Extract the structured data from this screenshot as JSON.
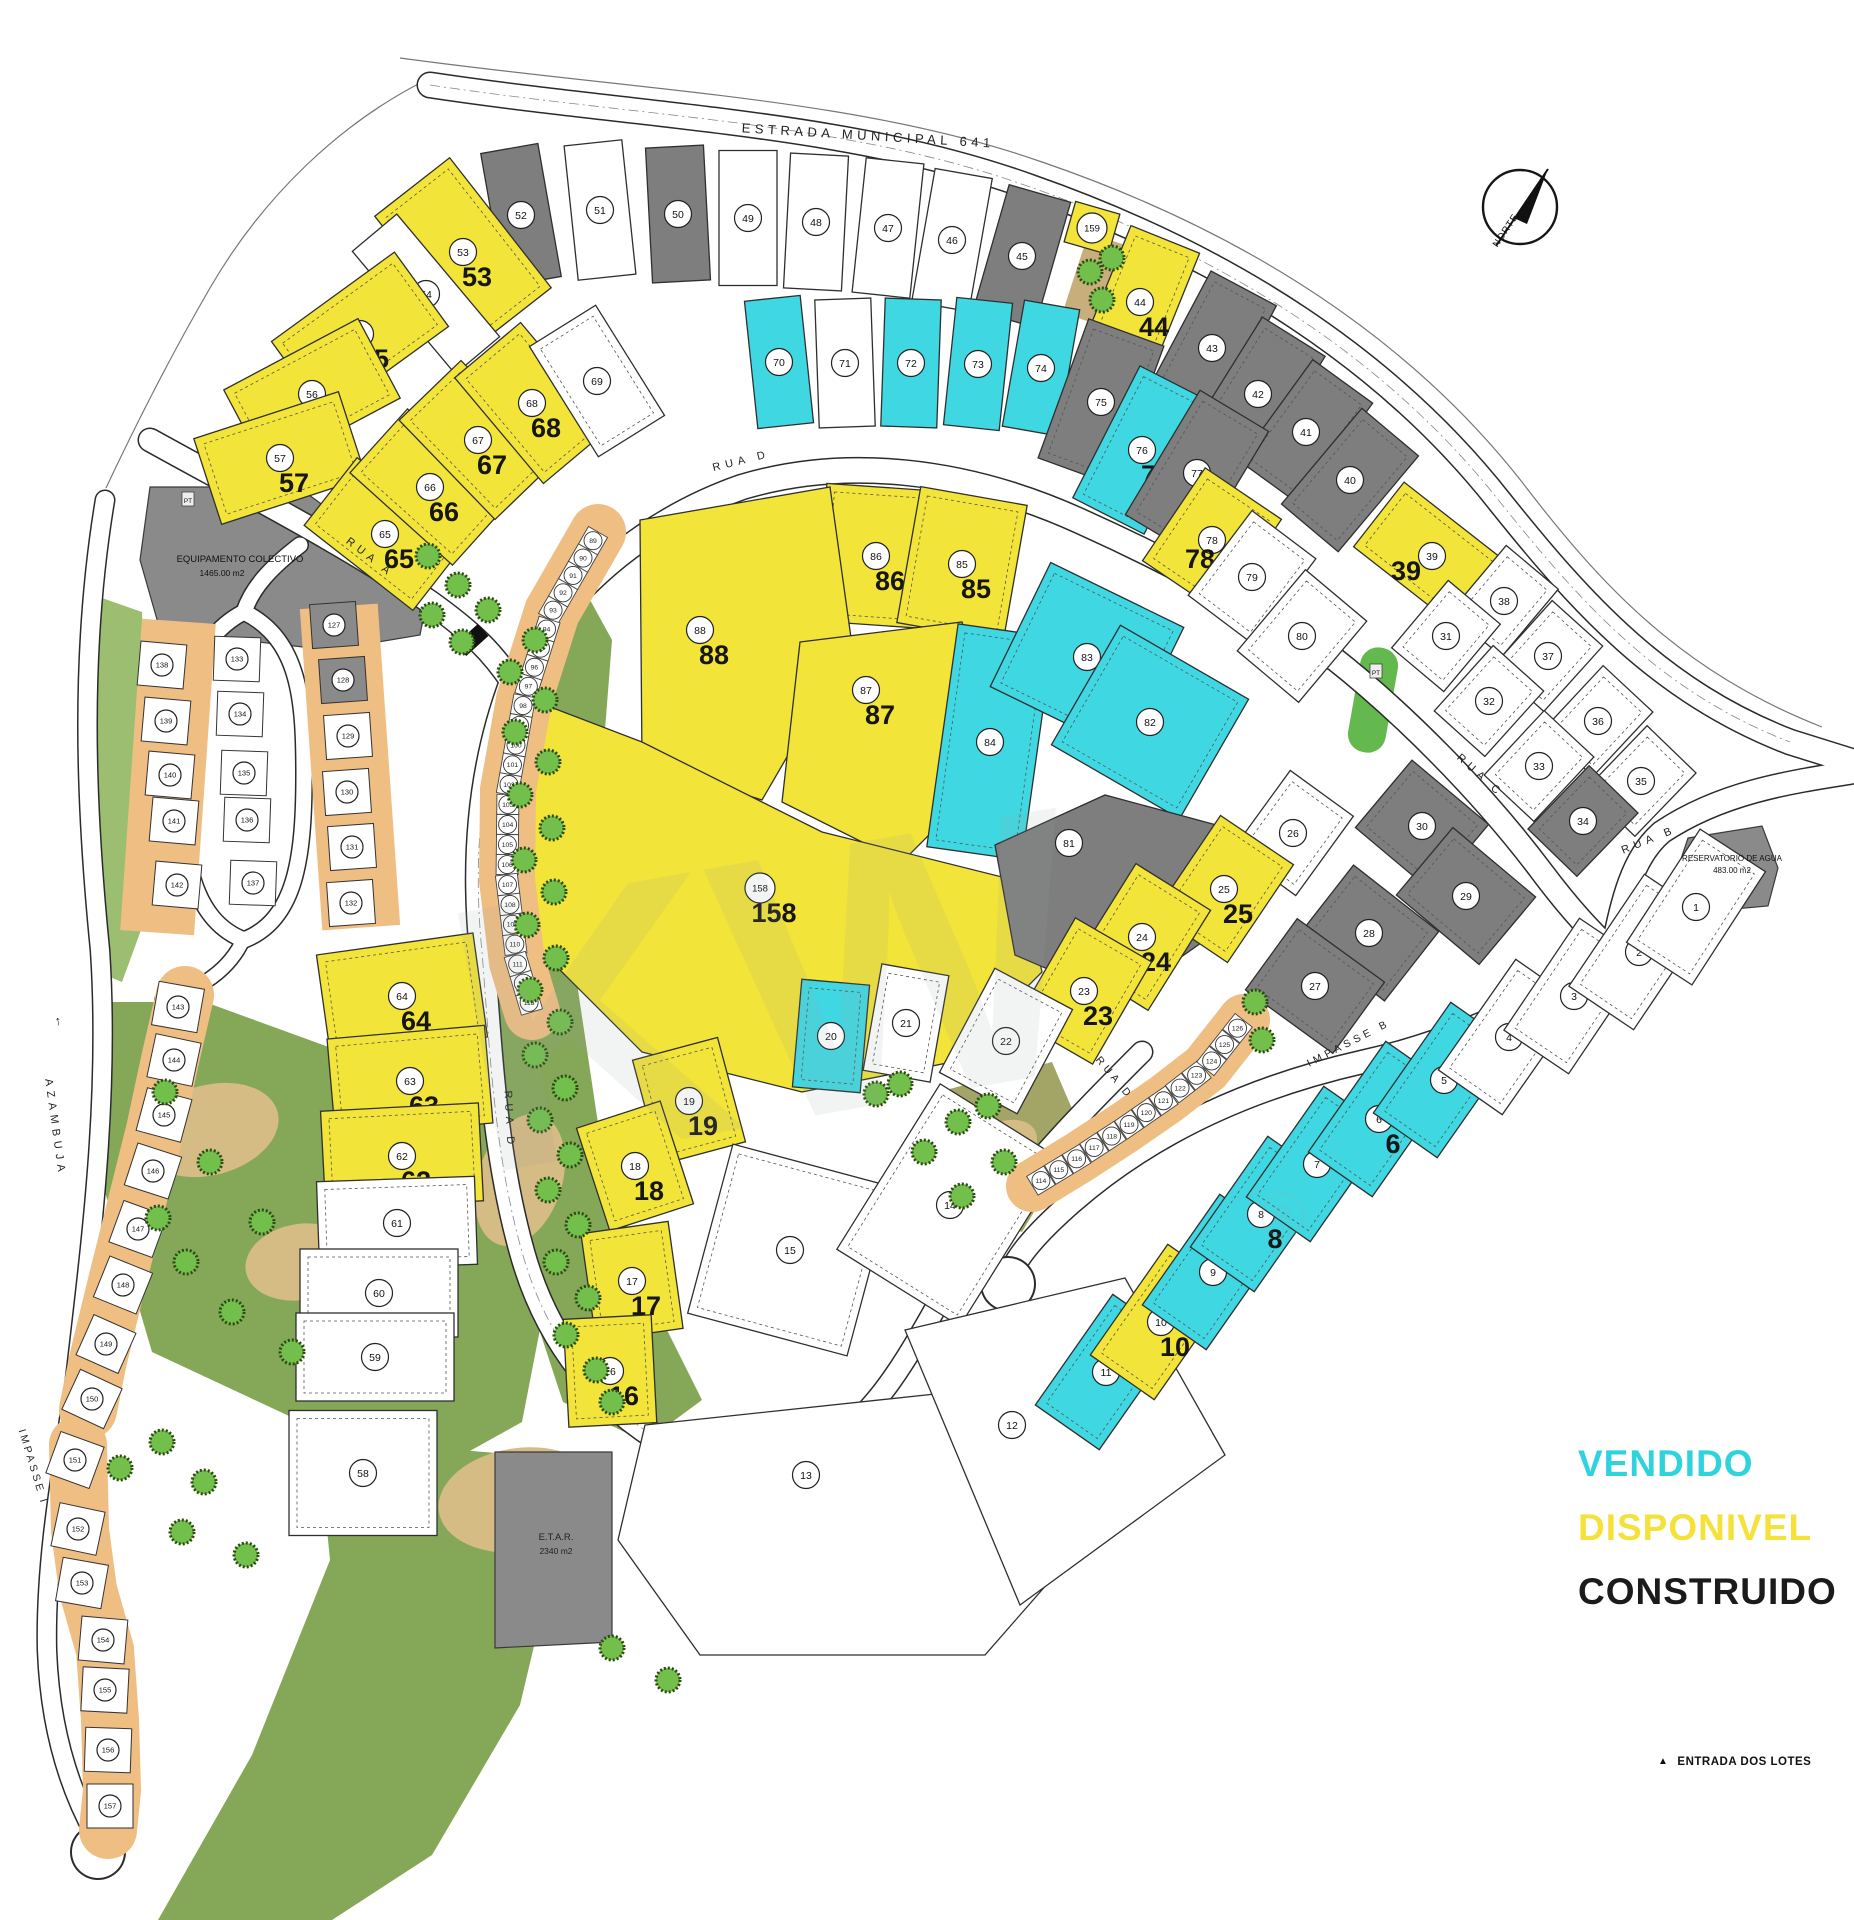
{
  "legend": {
    "items": [
      {
        "id": "vendido",
        "label": "VENDIDO",
        "color": "#2FD3DE"
      },
      {
        "id": "disponivel",
        "label": "DISPONIVEL",
        "color": "#F4E23B"
      },
      {
        "id": "construido",
        "label": "CONSTRUIDO",
        "color": "#1B1B1B"
      }
    ]
  },
  "notes": {
    "entrance": "ENTRADA DOS LOTES"
  },
  "north_label": "NORTE",
  "roads": {
    "estrada": "ESTRADA MUNICIPAL 641",
    "rua_a": "RUA A",
    "rua_b": "RUA B",
    "rua_c": "RUA C",
    "rua_d": "RUA D",
    "impasse_b": "IMPASSE B",
    "impasse_i": "IMPASSE I",
    "azambuja": "AZAMBUJA"
  },
  "areas": {
    "equipamento": {
      "name": "EQUIPAMENTO COLECTIVO",
      "area": "1465.00 m2"
    },
    "reservatorio": {
      "name": "RESERVATORIO DE AGUA",
      "area": "483.00 m2"
    },
    "etar": {
      "name": "E.T.A.R.",
      "area": "2340 m2"
    },
    "pt_marker": "PT"
  },
  "status_colors": {
    "v": "#3FD8E2",
    "d": "#F2E438",
    "c": "#7E7E7E",
    "w": "#FFFFFF"
  },
  "status_names": {
    "v": "vendido",
    "d": "disponivel",
    "c": "construido",
    "w": "livre"
  },
  "arcs": {
    "west_townhouses": {
      "start": 89,
      "end": 113
    },
    "south_townhouses": {
      "start": 114,
      "end": 126
    }
  },
  "plots": [
    {
      "n": 52,
      "s": "c",
      "x": 521,
      "y": 215,
      "w": 58,
      "h": 135,
      "a": -10
    },
    {
      "n": 51,
      "s": "w",
      "x": 600,
      "y": 210,
      "w": 58,
      "h": 135,
      "a": -6
    },
    {
      "n": 50,
      "s": "c",
      "x": 678,
      "y": 214,
      "w": 58,
      "h": 135,
      "a": -3
    },
    {
      "n": 49,
      "s": "w",
      "x": 748,
      "y": 218,
      "w": 58,
      "h": 135,
      "a": 0
    },
    {
      "n": 48,
      "s": "w",
      "x": 816,
      "y": 222,
      "w": 58,
      "h": 135,
      "a": 3
    },
    {
      "n": 47,
      "s": "w",
      "x": 888,
      "y": 228,
      "w": 58,
      "h": 135,
      "a": 6
    },
    {
      "n": 46,
      "s": "w",
      "x": 952,
      "y": 240,
      "w": 58,
      "h": 135,
      "a": 10
    },
    {
      "n": 45,
      "s": "c",
      "x": 1022,
      "y": 256,
      "w": 64,
      "h": 130,
      "a": 16
    },
    {
      "n": 159,
      "s": "d",
      "x": 1092,
      "y": 228,
      "w": 46,
      "h": 42,
      "a": 16
    },
    {
      "n": 44,
      "s": "d",
      "x": 1140,
      "y": 302,
      "w": 74,
      "h": 135,
      "a": 22,
      "b": 1
    },
    {
      "n": 43,
      "s": "c",
      "x": 1212,
      "y": 348,
      "w": 74,
      "h": 135,
      "a": 28
    },
    {
      "n": 42,
      "s": "c",
      "x": 1258,
      "y": 394,
      "w": 74,
      "h": 135,
      "a": 32
    },
    {
      "n": 41,
      "s": "c",
      "x": 1306,
      "y": 432,
      "w": 74,
      "h": 125,
      "a": 36
    },
    {
      "n": 40,
      "s": "c",
      "x": 1350,
      "y": 480,
      "w": 74,
      "h": 125,
      "a": 40
    },
    {
      "n": 53,
      "s": "d",
      "x": 463,
      "y": 252,
      "w": 95,
      "h": 165,
      "a": -38,
      "b": 1
    },
    {
      "n": 54,
      "s": "w",
      "x": 426,
      "y": 294,
      "w": 58,
      "h": 160,
      "a": -40
    },
    {
      "n": 55,
      "s": "d",
      "x": 360,
      "y": 334,
      "w": 152,
      "h": 92,
      "a": -36,
      "b": 1
    },
    {
      "n": 56,
      "s": "d",
      "x": 312,
      "y": 394,
      "w": 152,
      "h": 90,
      "a": -28,
      "b": 1
    },
    {
      "n": 57,
      "s": "d",
      "x": 280,
      "y": 458,
      "w": 152,
      "h": 90,
      "a": -18,
      "b": 1
    },
    {
      "n": 65,
      "s": "d",
      "x": 385,
      "y": 534,
      "w": 86,
      "h": 138,
      "a": -52,
      "b": 1
    },
    {
      "n": 66,
      "s": "d",
      "x": 430,
      "y": 487,
      "w": 86,
      "h": 138,
      "a": -48,
      "b": 1
    },
    {
      "n": 67,
      "s": "d",
      "x": 478,
      "y": 440,
      "w": 86,
      "h": 138,
      "a": -44,
      "b": 1
    },
    {
      "n": 68,
      "s": "d",
      "x": 532,
      "y": 403,
      "w": 86,
      "h": 138,
      "a": -40,
      "b": 1
    },
    {
      "n": 69,
      "s": "w",
      "x": 597,
      "y": 381,
      "w": 78,
      "h": 130,
      "a": -32
    },
    {
      "n": 70,
      "s": "v",
      "x": 779,
      "y": 362,
      "w": 56,
      "h": 128,
      "a": -6
    },
    {
      "n": 71,
      "s": "w",
      "x": 845,
      "y": 363,
      "w": 56,
      "h": 128,
      "a": -2
    },
    {
      "n": 72,
      "s": "v",
      "x": 911,
      "y": 363,
      "w": 56,
      "h": 128,
      "a": 2
    },
    {
      "n": 73,
      "s": "v",
      "x": 978,
      "y": 364,
      "w": 56,
      "h": 128,
      "a": 6
    },
    {
      "n": 74,
      "s": "v",
      "x": 1041,
      "y": 368,
      "w": 56,
      "h": 128,
      "a": 10
    },
    {
      "n": 75,
      "s": "c",
      "x": 1101,
      "y": 402,
      "w": 80,
      "h": 148,
      "a": 20
    },
    {
      "n": 76,
      "s": "v",
      "x": 1142,
      "y": 450,
      "w": 80,
      "h": 148,
      "a": 27,
      "b": 1
    },
    {
      "n": 77,
      "s": "c",
      "x": 1197,
      "y": 473,
      "w": 80,
      "h": 145,
      "a": 31
    },
    {
      "n": 78,
      "s": "d",
      "x": 1212,
      "y": 540,
      "w": 92,
      "h": 112,
      "a": 34,
      "b": 1,
      "dx": -12,
      "dy": 28
    },
    {
      "n": 79,
      "s": "w",
      "x": 1252,
      "y": 577,
      "w": 80,
      "h": 106,
      "a": 37
    },
    {
      "n": 80,
      "s": "w",
      "x": 1302,
      "y": 636,
      "w": 80,
      "h": 106,
      "a": 40
    },
    {
      "n": 39,
      "s": "d",
      "x": 1432,
      "y": 556,
      "w": 135,
      "h": 82,
      "a": 38,
      "b": 1,
      "dx": -26,
      "dy": 24
    },
    {
      "n": 38,
      "s": "w",
      "x": 1504,
      "y": 601,
      "w": 68,
      "h": 88,
      "a": 40
    },
    {
      "n": 31,
      "s": "w",
      "x": 1446,
      "y": 636,
      "w": 68,
      "h": 88,
      "a": 40
    },
    {
      "n": 37,
      "s": "w",
      "x": 1548,
      "y": 656,
      "w": 68,
      "h": 88,
      "a": 42
    },
    {
      "n": 32,
      "s": "w",
      "x": 1489,
      "y": 701,
      "w": 68,
      "h": 88,
      "a": 42
    },
    {
      "n": 36,
      "s": "w",
      "x": 1598,
      "y": 721,
      "w": 68,
      "h": 88,
      "a": 43
    },
    {
      "n": 33,
      "s": "w",
      "x": 1539,
      "y": 766,
      "w": 68,
      "h": 88,
      "a": 43
    },
    {
      "n": 35,
      "s": "w",
      "x": 1641,
      "y": 781,
      "w": 68,
      "h": 88,
      "a": 44
    },
    {
      "n": 34,
      "s": "c",
      "x": 1583,
      "y": 821,
      "w": 68,
      "h": 88,
      "a": 44
    },
    {
      "n": 86,
      "s": "d",
      "x": 876,
      "y": 556,
      "w": 108,
      "h": 138,
      "a": 4,
      "b": 1
    },
    {
      "n": 85,
      "s": "d",
      "x": 962,
      "y": 564,
      "w": 108,
      "h": 138,
      "a": 10,
      "b": 1
    },
    {
      "n": 88,
      "s": "d",
      "p": "640,520 830,487 852,645 762,800 642,762",
      "x": 700,
      "y": 630,
      "b": 1
    },
    {
      "n": 87,
      "s": "d",
      "p": "800,642 962,622 1002,762 902,862 782,802",
      "x": 866,
      "y": 690,
      "b": 1
    },
    {
      "n": 158,
      "s": "d",
      "p": "532,700 642,742 822,832 1022,882 1042,972 952,1062 802,1092 642,1052 542,952 512,802",
      "x": 760,
      "y": 888,
      "b": 1
    },
    {
      "n": 84,
      "s": "v",
      "x": 990,
      "y": 742,
      "w": 96,
      "h": 225,
      "a": 8
    },
    {
      "n": 83,
      "s": "v",
      "x": 1087,
      "y": 657,
      "w": 148,
      "h": 138,
      "a": 26
    },
    {
      "n": 82,
      "s": "v",
      "x": 1150,
      "y": 722,
      "w": 148,
      "h": 138,
      "a": 30
    },
    {
      "n": 81,
      "s": "c",
      "p": "995,845 1105,795 1235,830 1255,905 1120,1000 1015,955",
      "x": 1069,
      "y": 843
    },
    {
      "n": 30,
      "s": "c",
      "x": 1422,
      "y": 826,
      "w": 100,
      "h": 88,
      "a": 40
    },
    {
      "n": 29,
      "s": "c",
      "x": 1466,
      "y": 896,
      "w": 108,
      "h": 88,
      "a": 40
    },
    {
      "n": 28,
      "s": "c",
      "x": 1369,
      "y": 933,
      "w": 108,
      "h": 88,
      "a": 38
    },
    {
      "n": 27,
      "s": "c",
      "x": 1315,
      "y": 986,
      "w": 108,
      "h": 88,
      "a": 36
    },
    {
      "n": 26,
      "s": "w",
      "x": 1293,
      "y": 833,
      "w": 78,
      "h": 98,
      "a": 36
    },
    {
      "n": 25,
      "s": "d",
      "x": 1224,
      "y": 889,
      "w": 88,
      "h": 118,
      "a": 34,
      "b": 1
    },
    {
      "n": 24,
      "s": "d",
      "x": 1142,
      "y": 937,
      "w": 88,
      "h": 118,
      "a": 32,
      "b": 1
    },
    {
      "n": 23,
      "s": "d",
      "x": 1084,
      "y": 991,
      "w": 88,
      "h": 118,
      "a": 30,
      "b": 1
    },
    {
      "n": 22,
      "s": "w",
      "x": 1006,
      "y": 1041,
      "w": 88,
      "h": 118,
      "a": 28
    },
    {
      "n": 21,
      "s": "w",
      "x": 906,
      "y": 1023,
      "w": 68,
      "h": 108,
      "a": 10
    },
    {
      "n": 20,
      "s": "v",
      "x": 831,
      "y": 1036,
      "w": 68,
      "h": 108,
      "a": 5
    },
    {
      "n": 19,
      "s": "d",
      "x": 689,
      "y": 1101,
      "w": 88,
      "h": 108,
      "a": -15,
      "b": 1
    },
    {
      "n": 18,
      "s": "d",
      "x": 635,
      "y": 1166,
      "w": 88,
      "h": 108,
      "a": -18,
      "b": 1
    },
    {
      "n": 17,
      "s": "d",
      "x": 632,
      "y": 1281,
      "w": 88,
      "h": 108,
      "a": -8,
      "b": 1
    },
    {
      "n": 16,
      "s": "d",
      "x": 610,
      "y": 1371,
      "w": 88,
      "h": 108,
      "a": -3,
      "b": 1
    },
    {
      "n": 15,
      "s": "w",
      "x": 790,
      "y": 1250,
      "w": 165,
      "h": 175,
      "a": 15
    },
    {
      "n": 14,
      "s": "w",
      "x": 950,
      "y": 1205,
      "w": 145,
      "h": 195,
      "a": 32
    },
    {
      "n": 13,
      "s": "w",
      "p": "645,1425 1085,1378 1125,1495 985,1655 700,1655 618,1540",
      "x": 806,
      "y": 1475
    },
    {
      "n": 12,
      "s": "w",
      "p": "905,1330 1125,1278 1225,1455 1020,1605",
      "x": 1012,
      "y": 1425
    },
    {
      "n": 11,
      "s": "v",
      "x": 1106,
      "y": 1372,
      "w": 78,
      "h": 135,
      "a": 35
    },
    {
      "n": 10,
      "s": "d",
      "x": 1161,
      "y": 1322,
      "w": 78,
      "h": 135,
      "a": 35,
      "b": 1
    },
    {
      "n": 9,
      "s": "v",
      "x": 1213,
      "y": 1272,
      "w": 78,
      "h": 135,
      "a": 35
    },
    {
      "n": 8,
      "s": "v",
      "x": 1261,
      "y": 1214,
      "w": 78,
      "h": 135,
      "a": 35,
      "b": 1
    },
    {
      "n": 7,
      "s": "v",
      "x": 1317,
      "y": 1164,
      "w": 78,
      "h": 135,
      "a": 35
    },
    {
      "n": 6,
      "s": "v",
      "x": 1379,
      "y": 1119,
      "w": 78,
      "h": 135,
      "a": 35,
      "b": 1
    },
    {
      "n": 5,
      "s": "v",
      "x": 1444,
      "y": 1080,
      "w": 78,
      "h": 135,
      "a": 35
    },
    {
      "n": 4,
      "s": "w",
      "x": 1509,
      "y": 1037,
      "w": 78,
      "h": 135,
      "a": 35
    },
    {
      "n": 3,
      "s": "w",
      "x": 1574,
      "y": 996,
      "w": 78,
      "h": 135,
      "a": 34
    },
    {
      "n": 2,
      "s": "w",
      "x": 1639,
      "y": 952,
      "w": 78,
      "h": 135,
      "a": 34
    },
    {
      "n": 1,
      "s": "w",
      "x": 1696,
      "y": 907,
      "w": 78,
      "h": 135,
      "a": 33
    },
    {
      "n": 64,
      "s": "d",
      "x": 402,
      "y": 996,
      "w": 158,
      "h": 105,
      "a": -8,
      "b": 1
    },
    {
      "n": 63,
      "s": "d",
      "x": 410,
      "y": 1081,
      "w": 158,
      "h": 98,
      "a": -5,
      "b": 1
    },
    {
      "n": 62,
      "s": "d",
      "x": 402,
      "y": 1156,
      "w": 158,
      "h": 98,
      "a": -3,
      "b": 1
    },
    {
      "n": 61,
      "s": "w",
      "x": 397,
      "y": 1223,
      "w": 158,
      "h": 88,
      "a": -2
    },
    {
      "n": 60,
      "s": "w",
      "x": 379,
      "y": 1293,
      "w": 158,
      "h": 88,
      "a": 0
    },
    {
      "n": 59,
      "s": "w",
      "x": 375,
      "y": 1357,
      "w": 158,
      "h": 88,
      "a": 0
    },
    {
      "n": 58,
      "s": "w",
      "x": 363,
      "y": 1473,
      "w": 148,
      "h": 125,
      "a": 0
    }
  ],
  "houses": [
    {
      "n": 127,
      "s": "c",
      "x": 334,
      "y": 625,
      "a": -4
    },
    {
      "n": 128,
      "s": "c",
      "x": 343,
      "y": 680,
      "a": -4
    },
    {
      "n": 129,
      "s": "w",
      "x": 348,
      "y": 736,
      "a": -4
    },
    {
      "n": 130,
      "s": "w",
      "x": 347,
      "y": 792,
      "a": -4
    },
    {
      "n": 131,
      "s": "w",
      "x": 352,
      "y": 847,
      "a": -4
    },
    {
      "n": 132,
      "s": "w",
      "x": 351,
      "y": 903,
      "a": -4
    },
    {
      "n": 133,
      "s": "w",
      "x": 237,
      "y": 659,
      "a": 2
    },
    {
      "n": 134,
      "s": "w",
      "x": 240,
      "y": 714,
      "a": 2
    },
    {
      "n": 135,
      "s": "w",
      "x": 244,
      "y": 773,
      "a": 2
    },
    {
      "n": 136,
      "s": "w",
      "x": 247,
      "y": 820,
      "a": 2
    },
    {
      "n": 137,
      "s": "w",
      "x": 253,
      "y": 883,
      "a": 2
    },
    {
      "n": 138,
      "s": "w",
      "x": 162,
      "y": 665,
      "a": 5
    },
    {
      "n": 139,
      "s": "w",
      "x": 166,
      "y": 721,
      "a": 5
    },
    {
      "n": 140,
      "s": "w",
      "x": 170,
      "y": 775,
      "a": 5
    },
    {
      "n": 141,
      "s": "w",
      "x": 174,
      "y": 821,
      "a": 5
    },
    {
      "n": 142,
      "s": "w",
      "x": 177,
      "y": 885,
      "a": 5
    },
    {
      "n": 143,
      "s": "w",
      "x": 178,
      "y": 1007,
      "a": 10
    },
    {
      "n": 144,
      "s": "w",
      "x": 174,
      "y": 1060,
      "a": 12
    },
    {
      "n": 145,
      "s": "w",
      "x": 164,
      "y": 1115,
      "a": 15
    },
    {
      "n": 146,
      "s": "w",
      "x": 153,
      "y": 1171,
      "a": 18
    },
    {
      "n": 147,
      "s": "w",
      "x": 138,
      "y": 1229,
      "a": 20
    },
    {
      "n": 148,
      "s": "w",
      "x": 123,
      "y": 1285,
      "a": 22
    },
    {
      "n": 149,
      "s": "w",
      "x": 106,
      "y": 1344,
      "a": 24
    },
    {
      "n": 150,
      "s": "w",
      "x": 92,
      "y": 1399,
      "a": 25
    },
    {
      "n": 151,
      "s": "w",
      "x": 75,
      "y": 1460,
      "a": 20
    },
    {
      "n": 152,
      "s": "w",
      "x": 78,
      "y": 1529,
      "a": 12
    },
    {
      "n": 153,
      "s": "w",
      "x": 82,
      "y": 1583,
      "a": 10
    },
    {
      "n": 154,
      "s": "w",
      "x": 103,
      "y": 1640,
      "a": 5
    },
    {
      "n": 155,
      "s": "w",
      "x": 105,
      "y": 1690,
      "a": 3
    },
    {
      "n": 156,
      "s": "w",
      "x": 108,
      "y": 1750,
      "a": 2
    },
    {
      "n": 157,
      "s": "w",
      "x": 110,
      "y": 1806,
      "a": 0
    }
  ]
}
